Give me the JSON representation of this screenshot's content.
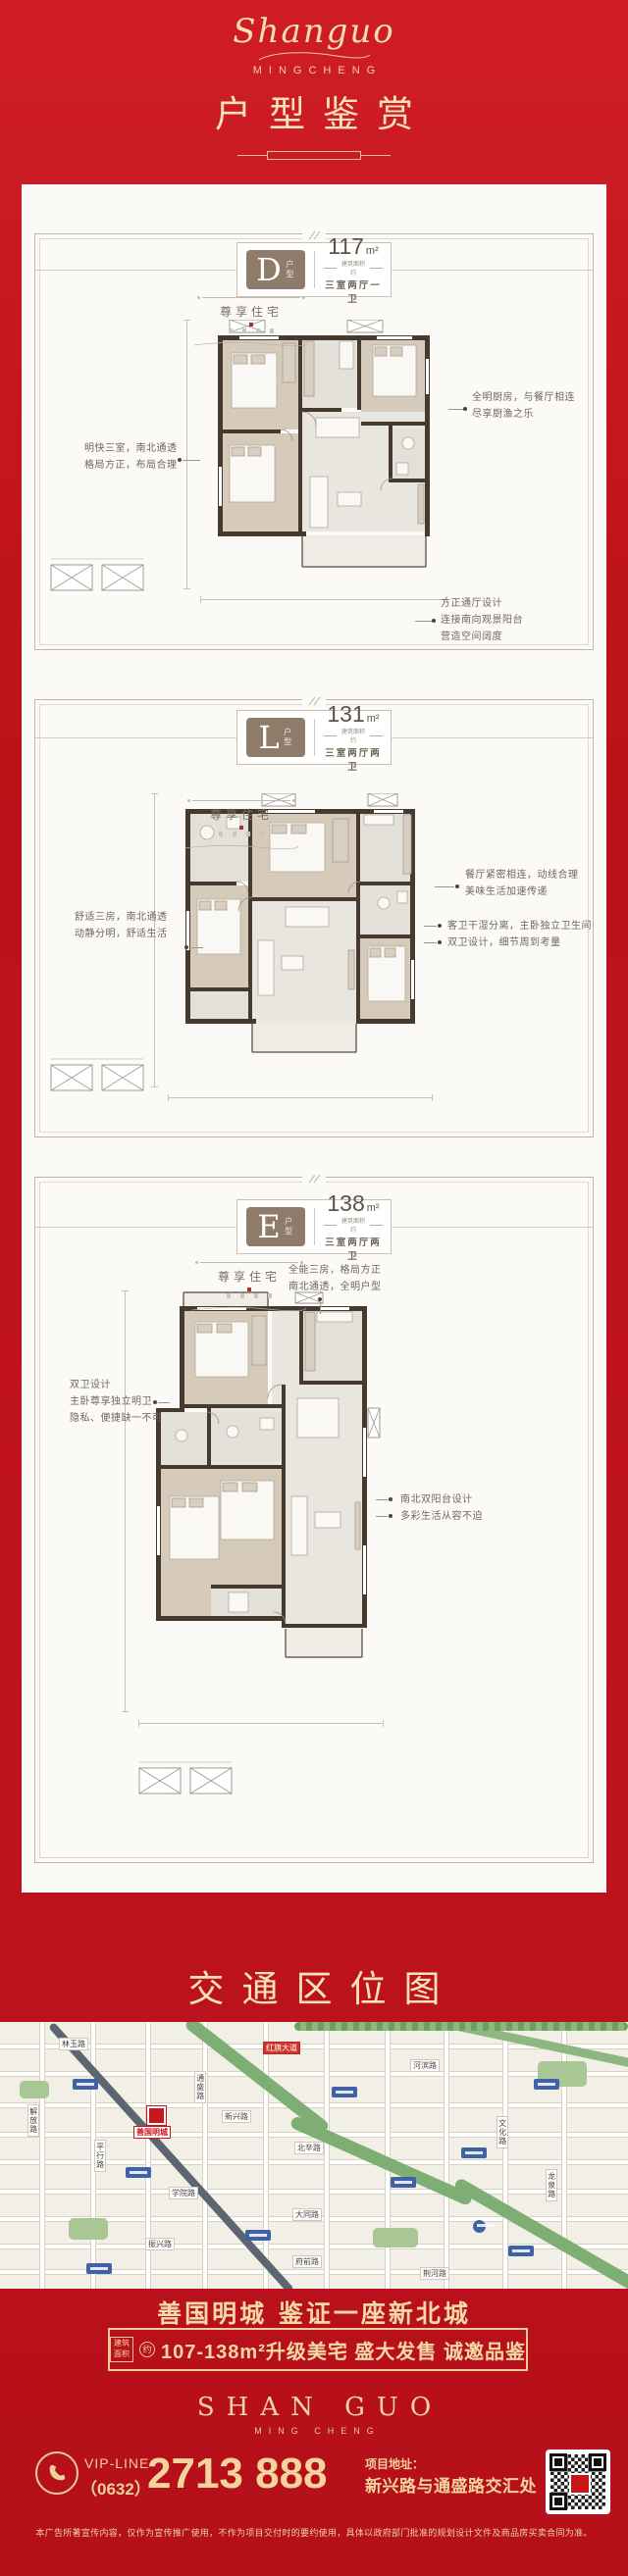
{
  "header": {
    "logo_script": "Shanguo",
    "logo_sub": "MINGCHENG",
    "title": "户型鉴赏"
  },
  "shared": {
    "type_suffix": "户型",
    "unit": "m²",
    "area_note": "建筑面积约",
    "mark_label": "尊享住宅"
  },
  "cards": [
    {
      "letter": "D",
      "area": "117",
      "rooms": "三室两厅一卫",
      "ann_left": [
        "明快三室，南北通透",
        "格局方正，布局合理"
      ],
      "ann_right_top": [
        "全明厨房，与餐厅相连",
        "尽享厨渔之乐"
      ],
      "ann_right_bottom": [
        "方正通厅设计",
        "连接南向观景阳台",
        "营造空间阔度"
      ]
    },
    {
      "letter": "L",
      "area": "131",
      "rooms": "三室两厅两卫",
      "ann_left": [
        "舒适三房，南北通透",
        "动静分明，舒适生活"
      ],
      "ann_right_top": [
        "餐厅紧密相连，动线合理",
        "美味生活加速传递"
      ],
      "ann_right_bottom": [
        "客卫干湿分离，主卧独立卫生间",
        "双卫设计，细节周到考量"
      ]
    },
    {
      "letter": "E",
      "area": "138",
      "rooms": "三室两厅两卫",
      "ann_top_right": [
        "全能三房，格局方正",
        "南北通透，全明户型"
      ],
      "ann_left": [
        "双卫设计",
        "主卧尊享独立明卫",
        "隐私、便捷缺一不可"
      ],
      "ann_right_bottom": [
        "南北双阳台设计",
        "多彩生活从容不迫"
      ]
    }
  ],
  "map_section": {
    "title": "交通区位图"
  },
  "map": {
    "project_label": "善国明城",
    "main_road": "红旗大道",
    "roads": [
      "林玉路",
      "河滨路",
      "解放路",
      "平行路",
      "通盛路",
      "新兴路",
      "北辛路",
      "文化路",
      "龙泉路",
      "学院路",
      "大同路",
      "振兴路",
      "府前路",
      "荆河路"
    ]
  },
  "footer": {
    "slogan": "善国明城 鉴证一座新北城",
    "banner_badge_top": "建筑",
    "banner_badge_bottom": "面积",
    "banner_circle": "约",
    "banner_text": "107-138m²升级美宅 盛大发售 诚邀品鉴",
    "brand_en": "SHAN GUO",
    "brand_en_sub": "MING CHENG",
    "vip_label": "VIP-LINE",
    "phone_area": "（0632）",
    "phone_number": "2713 888",
    "address_label": "项目地址：",
    "address": "新兴路与通盛路交汇处",
    "disclaimer": "本广告所著宣传内容，仅作为宣传推广使用，不作为项目交付时的要约使用，具体以政府部门批准的规划设计文件及商品房买卖合同为准。"
  }
}
